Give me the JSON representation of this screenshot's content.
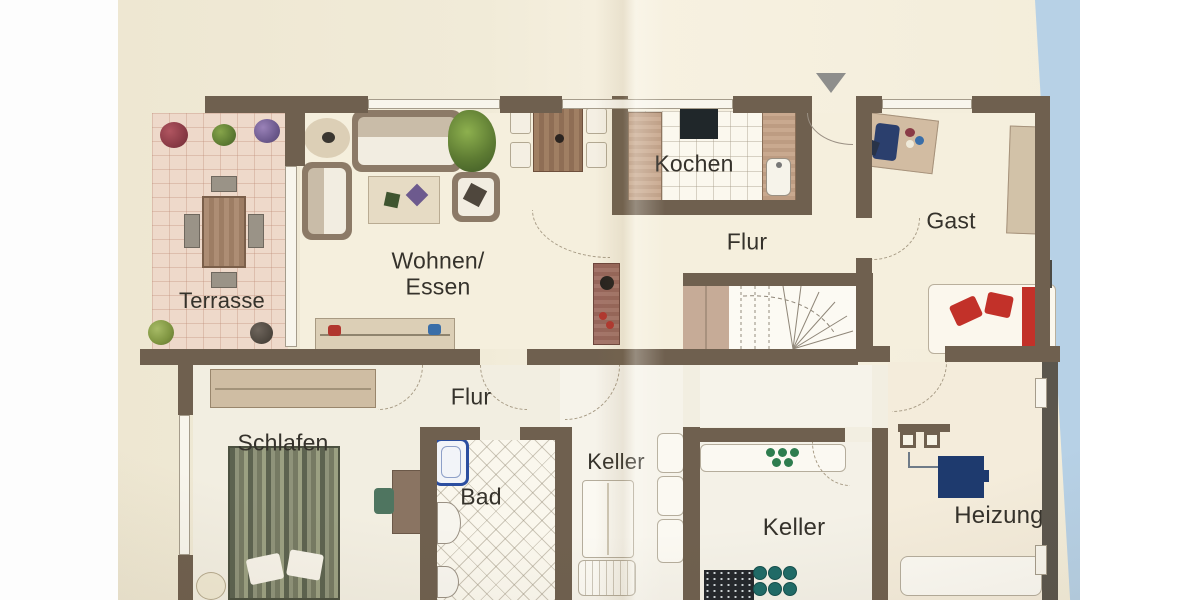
{
  "photo": {
    "kind": "scanned floor plan page",
    "paper_color": "#f2ecd9",
    "backdrop_blue": "#b7d1e6",
    "margin_white": "#ffffff"
  },
  "palette": {
    "wall_upper": "#6f604f",
    "wall_lower": "#5b564d",
    "label_text": "#35322b",
    "terrace_tile": "#eed9ca",
    "bed_green": "#767a63",
    "boiler_blue": "#1e3a6e",
    "bathtub_blue": "#2b4ea0",
    "accent_red": "#c23129",
    "storage_teal": "#1f6b68"
  },
  "marker": {
    "entrance_pointer": "triangle-down"
  },
  "rooms": {
    "terrasse": {
      "label": "Terrasse"
    },
    "wohnen_essen": {
      "label_line1": "Wohnen/",
      "label_line2": "Essen"
    },
    "kochen": {
      "label": "Kochen"
    },
    "flur_og": {
      "label": "Flur"
    },
    "gast": {
      "label": "Gast"
    },
    "schlafen": {
      "label": "Schlafen"
    },
    "flur_ug": {
      "label": "Flur"
    },
    "bad": {
      "label": "Bad"
    },
    "keller_1": {
      "label": "Keller"
    },
    "keller_2": {
      "label": "Keller"
    },
    "heizung": {
      "label": "Heizung"
    }
  }
}
